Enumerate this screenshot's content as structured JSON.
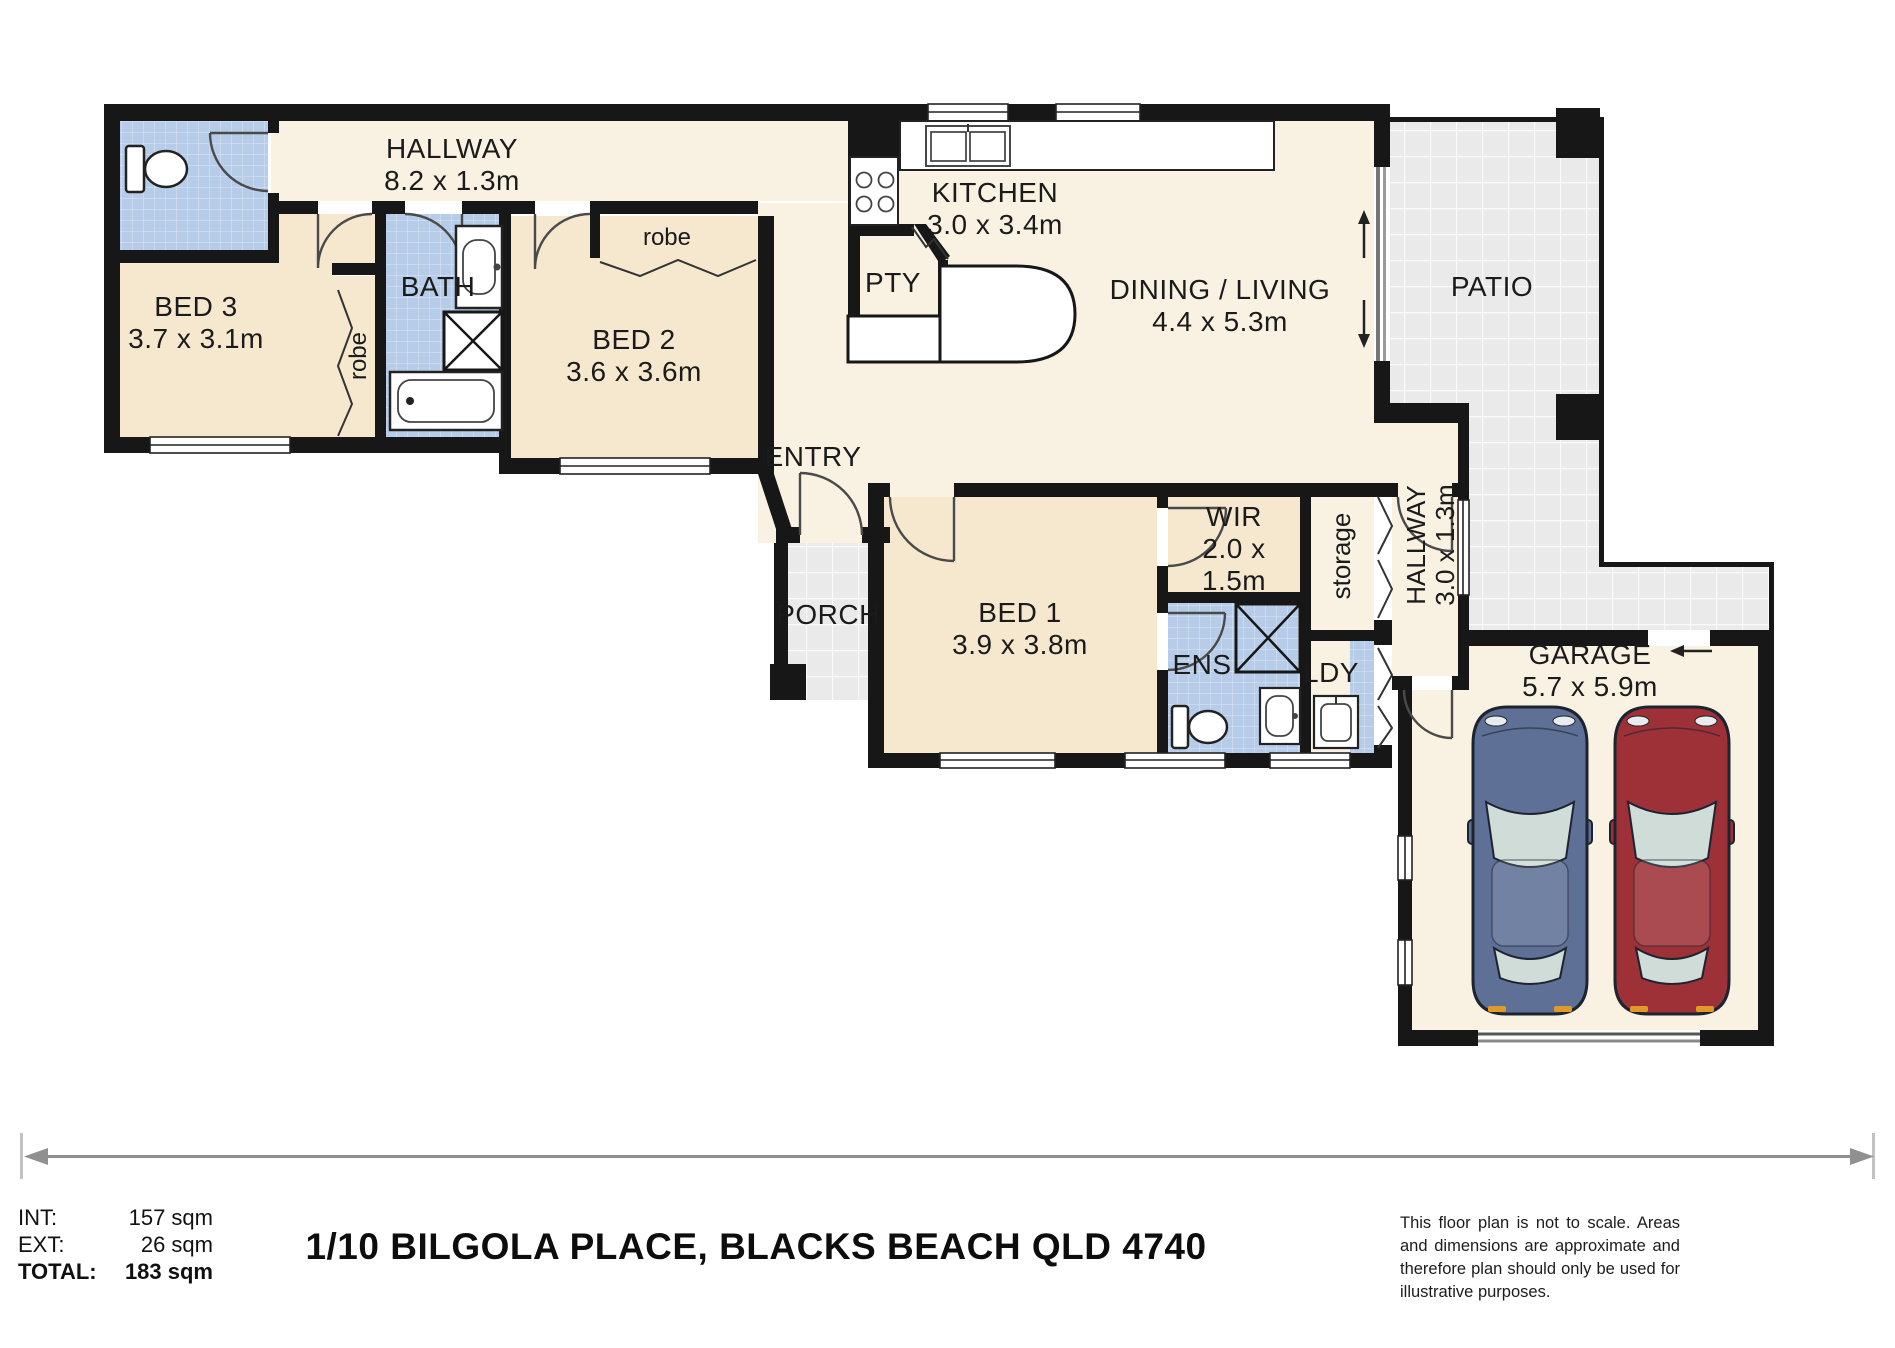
{
  "plan": {
    "rooms": {
      "hallway_top": {
        "label": "HALLWAY",
        "dims": "8.2 x 1.3m"
      },
      "bed3": {
        "label": "BED 3",
        "dims": "3.7 x 3.1m"
      },
      "robe_bed3": {
        "label": "robe"
      },
      "bath": {
        "label": "BATH"
      },
      "bed2": {
        "label": "BED 2",
        "dims": "3.6 x 3.6m"
      },
      "robe_bed2": {
        "label": "robe"
      },
      "kitchen": {
        "label": "KITCHEN",
        "dims": "3.0 x 3.4m"
      },
      "pantry": {
        "label": "PTY"
      },
      "dining": {
        "label": "DINING / LIVING",
        "dims": "4.4 x 5.3m"
      },
      "patio": {
        "label": "PATIO"
      },
      "entry": {
        "label": "ENTRY"
      },
      "porch": {
        "label": "PORCH"
      },
      "bed1": {
        "label": "BED 1",
        "dims": "3.9 x 3.8m"
      },
      "wir": {
        "label": "WIR",
        "dims_line1": "2.0 x",
        "dims_line2": "1.5m"
      },
      "storage": {
        "label": "storage"
      },
      "hallway2": {
        "label": "HALLWAY",
        "dims": "3.0 x 1.3m"
      },
      "ens": {
        "label": "ENS"
      },
      "ldy": {
        "label": "LDY"
      },
      "garage": {
        "label": "GARAGE",
        "dims": "5.7 x 5.9m"
      }
    },
    "colors": {
      "wall": "#171717",
      "bedroom_floor": "#f6e8cf",
      "living_floor": "#f9f2e3",
      "wet_area_tile": "#b6cce8",
      "outdoor_tile": "#eaeaea",
      "car_blue": "#5e7096",
      "car_red": "#9e3038"
    },
    "footer": {
      "areas": [
        {
          "label": "INT:",
          "value": "157 sqm"
        },
        {
          "label": "EXT:",
          "value": "26 sqm"
        },
        {
          "label": "TOTAL:",
          "value": "183 sqm"
        }
      ],
      "address": "1/10 BILGOLA PLACE, BLACKS BEACH QLD 4740",
      "disclaimer": "This floor plan is not to scale. Areas and dimensions are approximate and therefore plan should only be used for illustrative purposes."
    }
  }
}
